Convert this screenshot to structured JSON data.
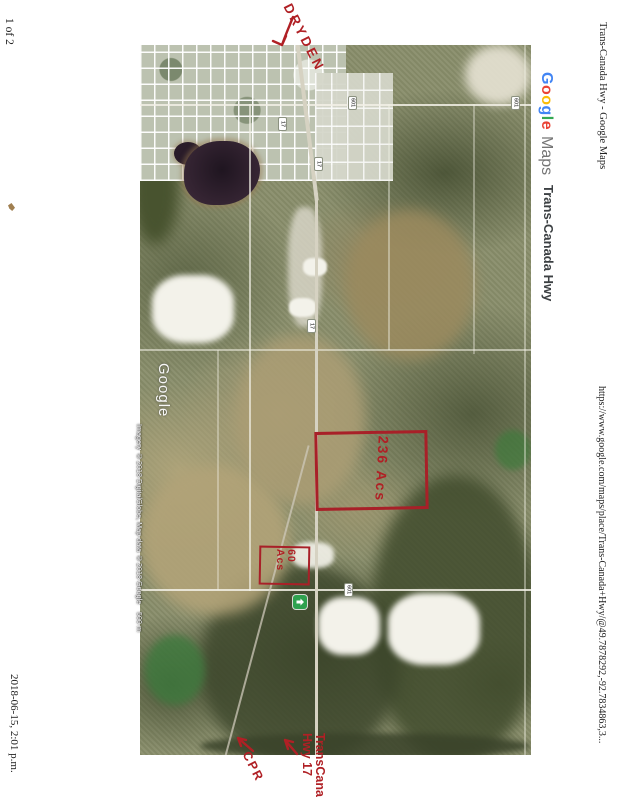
{
  "page": {
    "page_number": "1 of 2",
    "header_title": "Trans-Canada Hwy - Google Maps",
    "url": "https://www.google.com/maps/place/Trans-Canada+Hwy/@49.7878292,-92.7834863,3...",
    "timestamp": "2018-06-15, 2:01 p.m."
  },
  "branding": {
    "logo_letters": [
      {
        "ch": "G",
        "color": "#4285F4"
      },
      {
        "ch": "o",
        "color": "#EA4335"
      },
      {
        "ch": "o",
        "color": "#FBBC05"
      },
      {
        "ch": "g",
        "color": "#4285F4"
      },
      {
        "ch": "l",
        "color": "#34A853"
      },
      {
        "ch": "e",
        "color": "#EA4335"
      }
    ],
    "logo_suffix": "Maps",
    "logo_suffix_color": "#757575",
    "place_label": "Trans-Canada Hwy"
  },
  "map": {
    "watermark": "Google",
    "attribution": "Imagery ©2018 DigitalGlobe, Map data ©2018 Google",
    "scale_label": "500 m",
    "marker_color": "#2fa14f",
    "shields": [
      {
        "label": "17"
      },
      {
        "label": "17"
      },
      {
        "label": "17"
      },
      {
        "label": "601"
      },
      {
        "label": "601"
      },
      {
        "label": "601"
      }
    ],
    "annotations": {
      "ink_color": "#b02025",
      "town_label": "DRYDEN",
      "parcel_large_label": "236 Acs",
      "parcel_small_line1": "60",
      "parcel_small_line2": "Acs",
      "rail_label": "CPR",
      "highway_label_line1": "TransCana",
      "highway_label_line2": "Hwy 17"
    }
  }
}
